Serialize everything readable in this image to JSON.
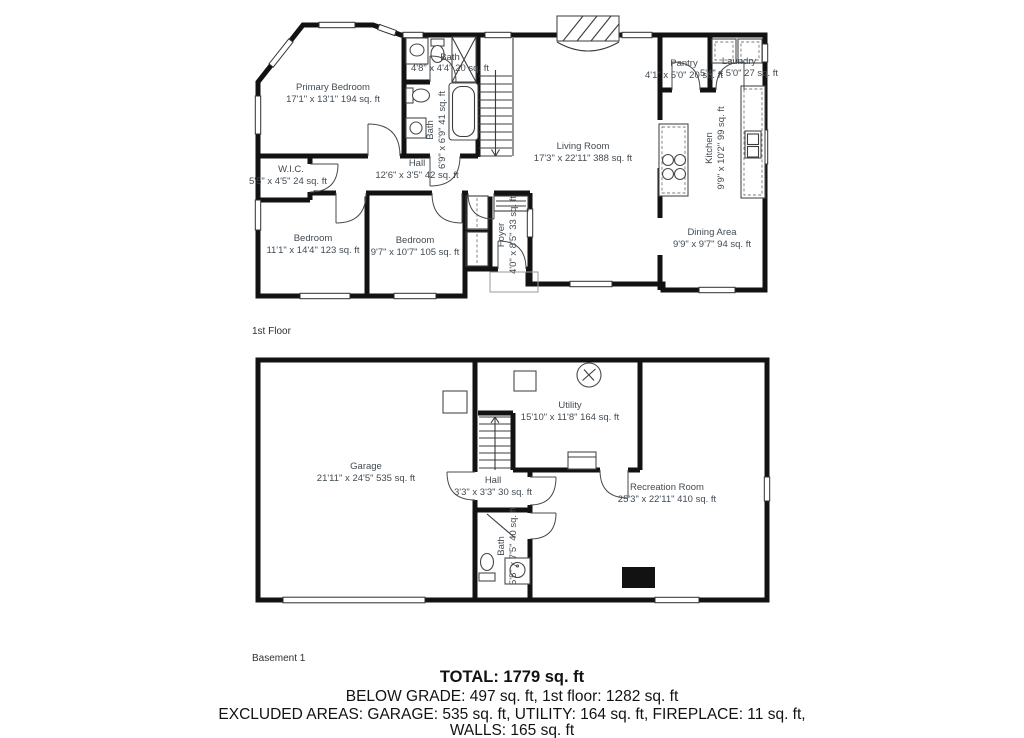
{
  "colors": {
    "wall": "#121212",
    "label": "#414b53",
    "fixture": "#4a4a4a",
    "summary": "#121212"
  },
  "floor1": {
    "label": "1st Floor",
    "rooms": {
      "primary_bedroom": {
        "name": "Primary Bedroom",
        "dims": "17'1\" x 13'1\" 194 sq. ft"
      },
      "bath_upper": {
        "name": "Bath",
        "dims": "4'8\" x 4'4\" 20 sq. ft"
      },
      "bath_primary": {
        "name": "Bath",
        "dims": "6'9\" x 6'9\" 41 sq. ft"
      },
      "wic": {
        "name": "W.I.C.",
        "dims": "5'5\" x 4'5\" 24 sq. ft"
      },
      "hall": {
        "name": "Hall",
        "dims": "12'6\" x 3'5\" 42 sq. ft"
      },
      "living_room": {
        "name": "Living Room",
        "dims": "17'3\" x 22'11\" 388 sq. ft"
      },
      "pantry": {
        "name": "Pantry",
        "dims": "4'1\" x 5'0\" 20 sq. ft"
      },
      "laundry": {
        "name": "Laundry",
        "dims": "5'4\" x 5'0\" 27 sq. ft"
      },
      "kitchen": {
        "name": "Kitchen",
        "dims": "9'9\" x 10'2\" 99 sq. ft"
      },
      "dining": {
        "name": "Dining Area",
        "dims": "9'9\" x 9'7\" 94 sq. ft"
      },
      "bedroom_left": {
        "name": "Bedroom",
        "dims": "11'1\" x 14'4\" 123 sq. ft"
      },
      "bedroom_mid": {
        "name": "Bedroom",
        "dims": "9'7\" x 10'7\" 105 sq. ft"
      },
      "foyer": {
        "name": "Foyer",
        "dims": "4'0\" x 8'5\" 33 sq. ft"
      }
    }
  },
  "basement": {
    "label": "Basement 1",
    "rooms": {
      "garage": {
        "name": "Garage",
        "dims": "21'11\" x 24'5\" 535 sq. ft"
      },
      "utility": {
        "name": "Utility",
        "dims": "15'10\" x 11'8\" 164 sq. ft"
      },
      "hall": {
        "name": "Hall",
        "dims": "3'3\" x 3'3\" 30 sq. ft"
      },
      "bath": {
        "name": "Bath",
        "dims": "5'5\" x 7'5\" 40 sq. ft"
      },
      "recreation": {
        "name": "Recreation Room",
        "dims": "25'3\" x 22'11\" 410 sq. ft"
      }
    }
  },
  "summary": {
    "total": "TOTAL: 1779 sq. ft",
    "line2": "BELOW GRADE: 497 sq. ft, 1st floor: 1282 sq. ft",
    "line3": "EXCLUDED AREAS: GARAGE: 535 sq. ft, UTILITY: 164 sq. ft, FIREPLACE: 11 sq. ft,",
    "line4": "WALLS: 165 sq. ft"
  }
}
